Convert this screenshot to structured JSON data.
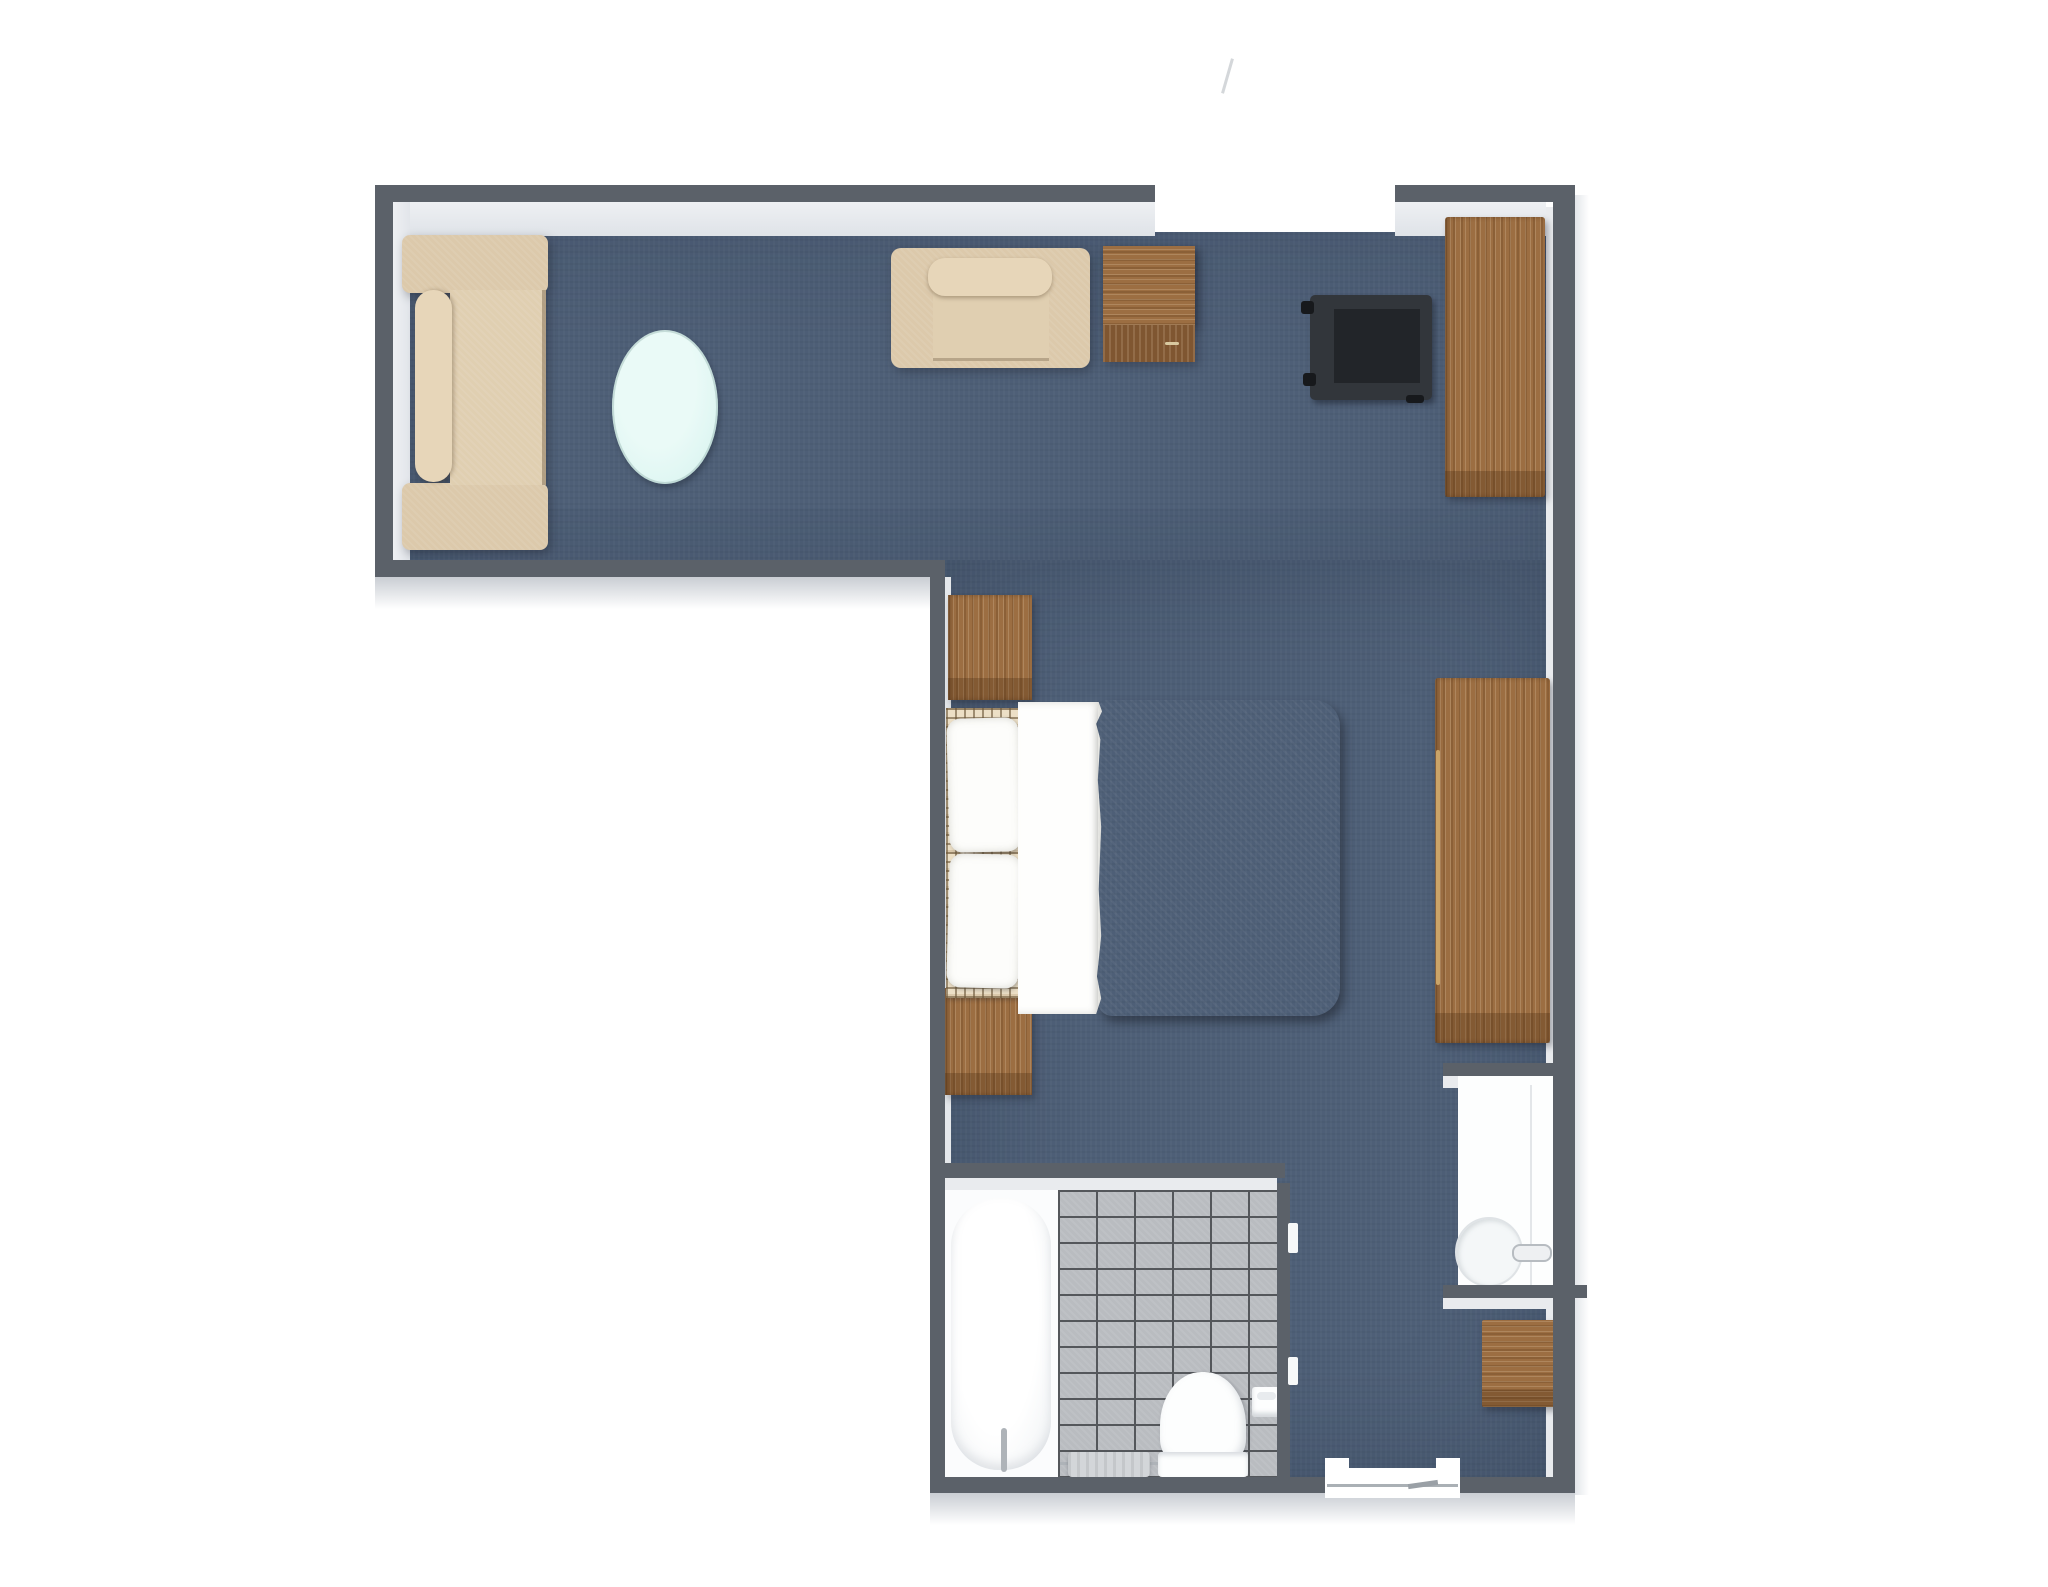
{
  "title": "3D top-down floor plan of an L-shaped hotel suite",
  "palette": {
    "bg": "#ffffff",
    "wall": "#5b6169",
    "wall_light": "#eef0f3",
    "wall_outer": "#c9cdd3",
    "floor": "#4e5f77",
    "tile": "#b9bcc0",
    "grout": "#54575b",
    "wood": "#9c6e42",
    "wood_dark": "#7f5631",
    "fabric": "#dcc9ab",
    "fabric_mid": "#e0cfb1",
    "fabric_light": "#e7d6b9",
    "duvet": "#6f5d3b",
    "duvet_dark": "#5f4f30",
    "plaid_base": "#ecdfc6",
    "white_fixture": "#fdfefe",
    "table_glass": "#def6f2",
    "black_furniture": "#32363b",
    "black_inner": "#222529",
    "towel": "#d3d6d9",
    "chrome": "#aeb3b8"
  },
  "rooms": [
    {
      "name": "living-area",
      "label": "Living area (top wing)",
      "floor": "slate-blue carpet",
      "features": [
        "beige sofa against west wall",
        "pale-cyan oval coffee table",
        "beige armchair against north wall",
        "wooden side table",
        "black luggage rack",
        "tall wooden dresser",
        "entrance opening in north wall with door swing tick"
      ]
    },
    {
      "name": "bedroom",
      "label": "Bedroom (right wing)",
      "floor": "slate-blue carpet",
      "features": [
        "double bed with plaid headboard, two white pillows, white sheet band and olive-brown duvet",
        "two wooden nightstands",
        "long wooden dresser on east wall",
        "small wooden cabinet near rear door",
        "recessed sink vanity niche with round basin and faucet",
        "door opening in south wall"
      ]
    },
    {
      "name": "bathroom",
      "label": "Bathroom (bottom of right wing)",
      "floor": "gray tile grid with white tub zone",
      "features": [
        "oval bathtub with faucet",
        "toilet with tank against south wall",
        "toilet-paper holder",
        "towel on rail",
        "gray partition wall with door tabs"
      ]
    }
  ],
  "furniture": [
    {
      "name": "sofa",
      "color": "#dcc9ab"
    },
    {
      "name": "coffee-table",
      "shape": "oval",
      "color": "#def6f2"
    },
    {
      "name": "armchair",
      "color": "#dcc9ab"
    },
    {
      "name": "side-table",
      "color": "#9c6e42"
    },
    {
      "name": "luggage-rack",
      "color": "#32363b"
    },
    {
      "name": "dresser-tall",
      "color": "#9c6e42"
    },
    {
      "name": "dresser-long",
      "color": "#9c6e42"
    },
    {
      "name": "cabinet-small",
      "color": "#9c6e42"
    },
    {
      "name": "nightstand",
      "count": 2,
      "color": "#9c6e42"
    },
    {
      "name": "double-bed",
      "duvet_color": "#6f5d3b",
      "pillows": 2
    },
    {
      "name": "bathtub",
      "color": "#fdfefe"
    },
    {
      "name": "toilet",
      "color": "#fdfefe"
    },
    {
      "name": "sink-basin",
      "color": "#f4f7f8"
    },
    {
      "name": "towel",
      "color": "#d3d6d9"
    }
  ]
}
